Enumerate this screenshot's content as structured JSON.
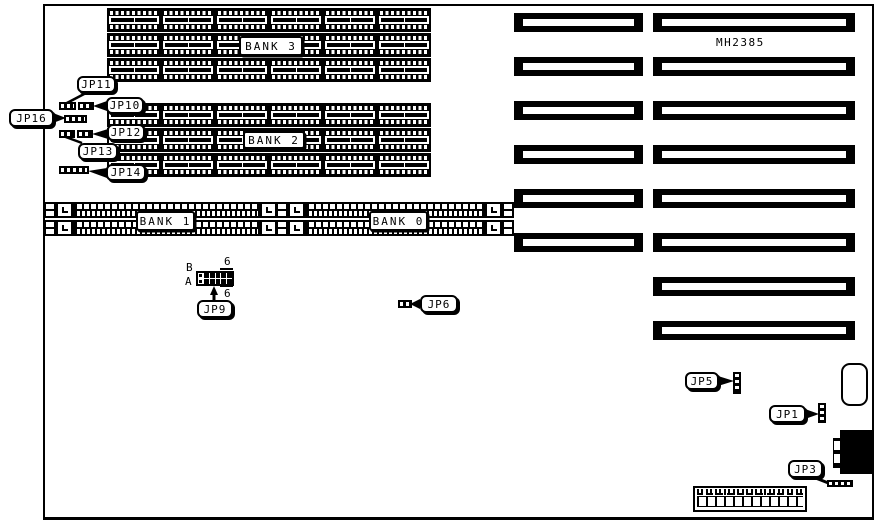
{
  "diagram": {
    "part_number": "MH2385",
    "bank_labels": {
      "bank0": "BANK 0",
      "bank1": "BANK 1",
      "bank2": "BANK 2",
      "bank3": "BANK 3"
    },
    "jumper_labels": {
      "jp1": "JP1",
      "jp3": "JP3",
      "jp5": "JP5",
      "jp6": "JP6",
      "jp9": "JP9",
      "jp10": "JP10",
      "jp11": "JP11",
      "jp12": "JP12",
      "jp13": "JP13",
      "jp14": "JP14",
      "jp16": "JP16"
    },
    "jp9_pins": {
      "row_b": "B",
      "row_a": "A",
      "pin6_top": "6",
      "pin6_bottom": "6"
    },
    "colors": {
      "ink": "#000000",
      "background": "#ffffff"
    }
  }
}
